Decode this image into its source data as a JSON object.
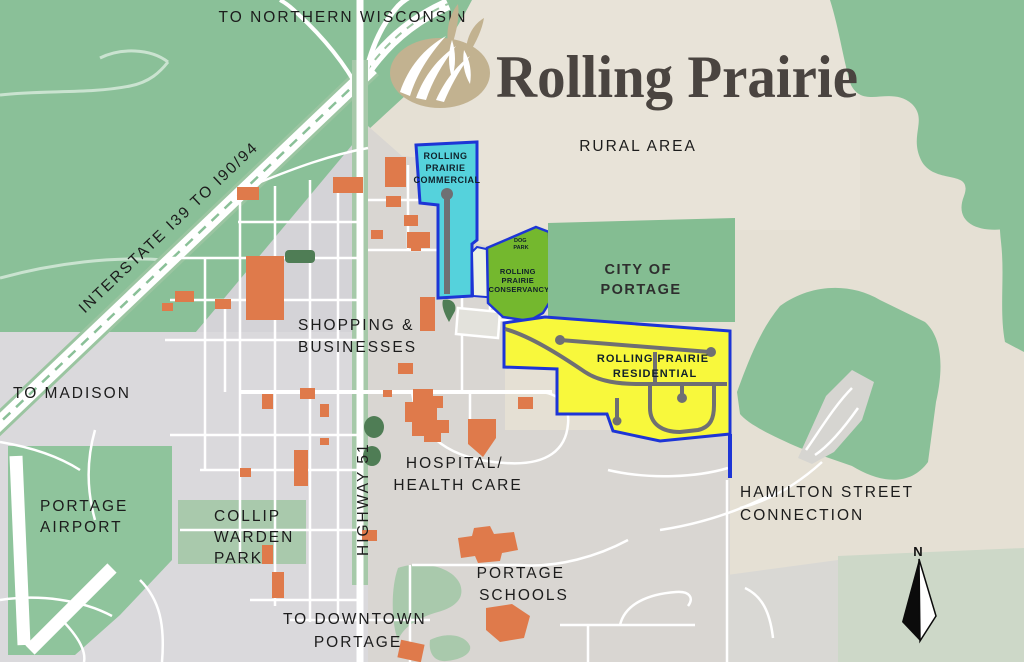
{
  "brand": {
    "name": "Rolling Prairie"
  },
  "compass": {
    "north": "N"
  },
  "labels": {
    "to_northern_wisconsin": "TO NORTHERN WISCONSIN",
    "interstate": "INTERSTATE I39 TO I90/94",
    "to_madison": "TO MADISON",
    "rural_area": "RURAL AREA",
    "highway_51": "HIGHWAY 51"
  },
  "zones": {
    "commercial": {
      "lines": [
        "ROLLING",
        "PRAIRIE",
        "COMMERCIAL"
      ]
    },
    "dog_park": {
      "lines": [
        "DOG",
        "PARK"
      ]
    },
    "conservancy": {
      "lines": [
        "ROLLING",
        "PRAIRIE",
        "CONSERVANCY"
      ]
    },
    "city_of_portage": {
      "lines": [
        "CITY OF",
        "PORTAGE"
      ]
    },
    "residential": {
      "lines": [
        "ROLLING PRAIRIE",
        "RESIDENTIAL"
      ]
    }
  },
  "places": {
    "shopping": [
      "SHOPPING &",
      "BUSINESSES"
    ],
    "hospital": [
      "HOSPITAL/",
      "HEALTH CARE"
    ],
    "airport": [
      "PORTAGE",
      "AIRPORT"
    ],
    "collip_warden_park": [
      "COLLIP",
      "WARDEN",
      "PARK"
    ],
    "downtown": [
      "TO DOWNTOWN",
      "PORTAGE"
    ],
    "schools": [
      "PORTAGE",
      "SCHOOLS"
    ],
    "hamilton": [
      "HAMILTON STREET",
      "CONNECTION"
    ]
  },
  "colors": {
    "background_beige": "#e5e0d4",
    "countryside_green": "#8ac098",
    "park_green": "#a9c9ac",
    "urban_gray": "#d5d4d8",
    "zone_border_blue": "#1d35d6",
    "commercial_cyan": "#55d2dc",
    "conservancy_green": "#74b82e",
    "city_green": "#84bd92",
    "residential_yellow": "#f8f83c",
    "building_orange": "#df7a4b",
    "logo_tan": "#c2b290",
    "label_black": "#1c1c1c"
  }
}
